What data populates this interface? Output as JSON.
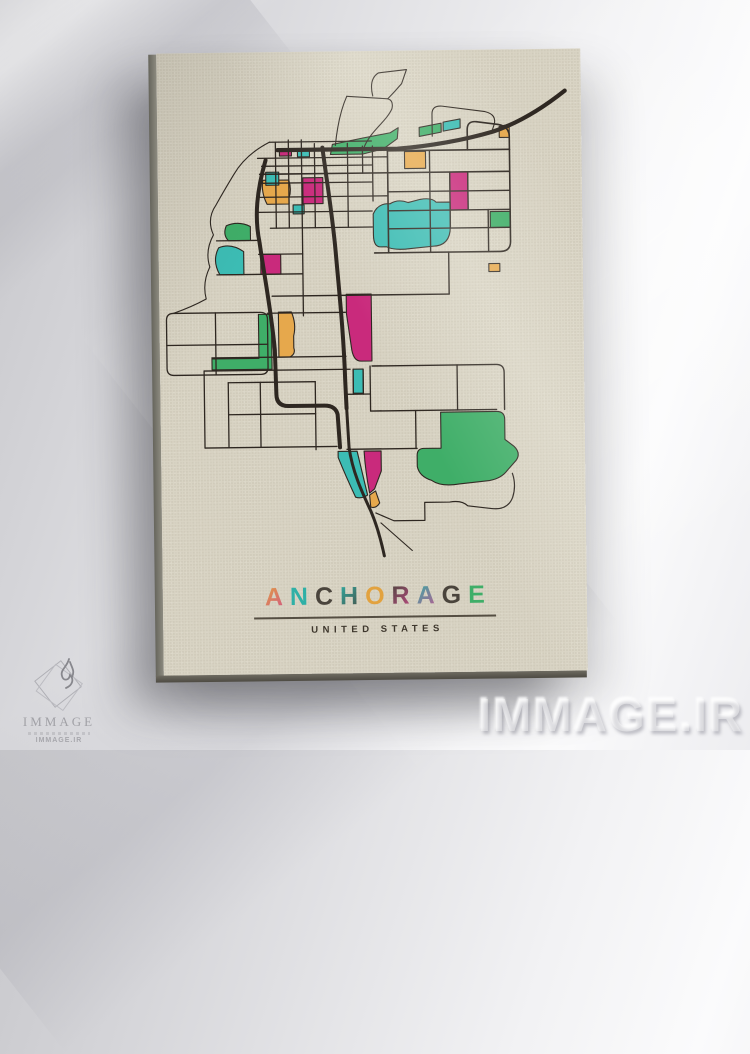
{
  "artwork": {
    "subtitle": "UNITED STATES",
    "title_letters": [
      {
        "ch": "A",
        "c1": "#e2a23f",
        "c2": "#cf4d8e"
      },
      {
        "ch": "N",
        "c1": "#2fb0a6",
        "c2": "#2fb0a6"
      },
      {
        "ch": "C",
        "c1": "#4a443c",
        "c2": "#4a443c"
      },
      {
        "ch": "H",
        "c1": "#2fb0a6",
        "c2": "#4a443c"
      },
      {
        "ch": "O",
        "c1": "#e2a23f",
        "c2": "#e2a23f"
      },
      {
        "ch": "R",
        "c1": "#4a443c",
        "c2": "#cf4d8e"
      },
      {
        "ch": "A",
        "c1": "#2fb0a6",
        "c2": "#cf4d8e"
      },
      {
        "ch": "G",
        "c1": "#4a443c",
        "c2": "#4a443c"
      },
      {
        "ch": "E",
        "c1": "#3fae68",
        "c2": "#3fae68"
      }
    ]
  },
  "watermark": {
    "text": "IMMAGE.IR"
  },
  "logo": {
    "name": "IMMAGE",
    "site": "IMMAGE.IR"
  },
  "map": {
    "colors": {
      "road": "#2e2721",
      "green": "#3fae68",
      "teal": "#3cbcb4",
      "magenta": "#c92a7c",
      "orange": "#e6a84c"
    },
    "parcels": [
      {
        "fill": "green",
        "d": "M173,103 L175,93 L205,87 L233,82 L241,77 L240,88 L226,98 L205,103 Z"
      },
      {
        "fill": "green",
        "d": "M262,77 L284,73 L284,82 L262,86 Z"
      },
      {
        "fill": "teal",
        "d": "M286,72 L303,69 L303,78 L286,81 Z"
      },
      {
        "fill": "orange",
        "d": "M342,77 L352,75 L352,88 L342,88 Z"
      },
      {
        "fill": "orange",
        "d": "M247,101 L268,101 L268,118 L247,118 Z"
      },
      {
        "fill": "magenta",
        "d": "M292,122 L310,122 L310,160 L292,160 Z"
      },
      {
        "fill": "green",
        "d": "M332,162 L352,162 L352,178 L332,178 Z"
      },
      {
        "fill": "teal",
        "d": "M215,163 Q220,152 232,153 Q240,148 250,152 L262,149 Q274,147 278,152 L292,152 L292,176 Q292,196 274,196 L252,198 Q236,200 228,196 L222,196 Q215,196 215,184 Z"
      },
      {
        "fill": "magenta",
        "d": "M145,126 L165,126 L165,152 L145,152 Z"
      },
      {
        "fill": "orange",
        "d": "M105,128 L131,128 Q134,138 131,146 L131,152 L109,152 Q103,140 105,128 Z"
      },
      {
        "fill": "teal",
        "d": "M108,120 L121,120 L121,133 L108,133 Z"
      },
      {
        "fill": "magenta",
        "d": "M122,97 L134,97 L134,104 L122,104 Z"
      },
      {
        "fill": "teal",
        "d": "M140,98 L152,98 L152,105 L140,105 Z"
      },
      {
        "fill": "teal",
        "d": "M135,153 L146,153 L146,162 L135,162 Z"
      },
      {
        "fill": "orange",
        "d": "M330,214 L341,214 L341,222 L330,222 Z"
      },
      {
        "fill": "green",
        "d": "M68,173 Q64,182 70,188 L92,188 L92,174 Q80,168 68,173 Z"
      },
      {
        "fill": "teal",
        "d": "M60,195 Q53,208 61,222 L85,222 L85,199 Q72,190 60,195 Z"
      },
      {
        "fill": "magenta",
        "d": "M102,202 L122,202 L122,222 L102,222 Z"
      },
      {
        "fill": "magenta",
        "d": "M187,243 L212,243 L212,310 L201,310 Q194,310 192,299 L187,262 Z"
      },
      {
        "fill": "teal",
        "d": "M193,318 L203,318 L203,342 L193,342 Z"
      },
      {
        "fill": "orange",
        "d": "M119,260 L132,260 Q137,272 134,284 L134,296 Q136,302 130,305 L119,305 Z"
      },
      {
        "fill": "green",
        "d": "M99,262 L112,262 L112,317 L52,317 L52,306 L99,306 Z"
      },
      {
        "fill": "green",
        "d": "M280,362 L336,362 Q344,362 344,370 L344,390 L353,397 Q360,404 355,411 L346,421 Q340,429 328,431 L298,434 Q280,437 270,430 Q258,426 256,416 L256,405 Q256,398 263,398 L280,398 Z"
      },
      {
        "fill": "teal",
        "d": "M177,400 L196,400 L206,444 Q200,448 194,446 Q184,424 177,406 Z"
      },
      {
        "fill": "magenta",
        "d": "M203,400 L220,400 L220,420 L213,438 L208,442 Q204,420 203,400 Z"
      },
      {
        "fill": "orange",
        "d": "M208,444 L214,440 L218,452 Q214,458 209,456 Z"
      }
    ],
    "roads": [
      {
        "w": 4.2,
        "d": "M408,42 C390,56 364,73 336,82 C308,90 272,96 240,98 L120,98"
      },
      {
        "w": 4.0,
        "d": "M165,96 C169,130 174,162 177,200 C180,240 184,282 185,330 L186,357"
      },
      {
        "w": 4.0,
        "d": "M108,108 C99,138 96,164 101,190 C106,228 112,260 115,298 L116,342 Q116,354 128,354 L164,354 Q175,354 177,363 L179,396"
      },
      {
        "w": 3.0,
        "d": "M186,355 L188,396 C191,420 200,440 209,460 C214,472 219,490 222,505"
      },
      {
        "w": 1.6,
        "d": "M230,97 L230,202"
      },
      {
        "w": 1.6,
        "d": "M352,100 L352,192 Q352,202 342,202 L216,202"
      },
      {
        "w": 1.6,
        "d": "M310,100 L310,80 Q310,71 319,72 L341,75 Q352,77 352,87 L352,100"
      },
      {
        "w": 1.6,
        "d": "M230,100 L352,100"
      },
      {
        "w": 1.6,
        "d": "M102,122 L352,122"
      },
      {
        "w": 1.4,
        "d": "M230,141 L352,141"
      },
      {
        "w": 1.4,
        "d": "M230,160 L352,160"
      },
      {
        "w": 1.4,
        "d": "M230,178 L352,178"
      },
      {
        "w": 1.4,
        "d": "M272,100 L272,202"
      },
      {
        "w": 1.4,
        "d": "M292,122 L292,178"
      },
      {
        "w": 1.4,
        "d": "M310,122 L310,160"
      },
      {
        "w": 1.4,
        "d": "M330,160 L330,202"
      },
      {
        "w": 1.3,
        "d": "M205,95 L205,122"
      },
      {
        "w": 1.3,
        "d": "M215,95 L215,150"
      },
      {
        "w": 1.3,
        "d": "M112,90 L214,90"
      },
      {
        "w": 1.3,
        "d": "M100,106 L230,106"
      },
      {
        "w": 1.3,
        "d": "M104,114 L214,114"
      },
      {
        "w": 1.3,
        "d": "M104,131 L214,131"
      },
      {
        "w": 1.3,
        "d": "M100,145 L230,145"
      },
      {
        "w": 1.3,
        "d": "M100,160 L214,160"
      },
      {
        "w": 1.3,
        "d": "M112,176 L214,176"
      },
      {
        "w": 1.3,
        "d": "M118,90 L118,176"
      },
      {
        "w": 1.3,
        "d": "M131,88 L131,176"
      },
      {
        "w": 1.3,
        "d": "M144,88 L144,264"
      },
      {
        "w": 1.3,
        "d": "M157,92 L157,176"
      },
      {
        "w": 1.3,
        "d": "M190,92 L190,176"
      },
      {
        "w": 1.1,
        "d": "M112,90 Q88,102 76,122 Q66,138 58,152 Q48,166 55,182 Q46,198 51,214 Q43,230 47,246 Q32,254 14,260"
      },
      {
        "w": 1.3,
        "d": "M58,188 L100,188"
      },
      {
        "w": 1.3,
        "d": "M58,222 L144,222"
      },
      {
        "w": 1.3,
        "d": "M100,202 L144,202"
      },
      {
        "w": 1.4,
        "d": "M113,244 L290,244"
      },
      {
        "w": 1.4,
        "d": "M290,244 L290,202"
      },
      {
        "w": 1.3,
        "d": "M14,260 Q7,260 7,267 L7,315 Q7,322 14,322 L101,322 Q108,322 108,315 L108,267 Q108,260 101,260 Z"
      },
      {
        "w": 1.3,
        "d": "M56,260 L56,322"
      },
      {
        "w": 1.3,
        "d": "M7,292 L108,292"
      },
      {
        "w": 1.3,
        "d": "M108,261 L186,261"
      },
      {
        "w": 1.3,
        "d": "M52,305 L186,305"
      },
      {
        "w": 1.3,
        "d": "M44,318 L190,318"
      },
      {
        "w": 1.3,
        "d": "M44,318 L44,395"
      },
      {
        "w": 1.3,
        "d": "M68,330 L155,330"
      },
      {
        "w": 1.3,
        "d": "M68,330 L68,395"
      },
      {
        "w": 1.3,
        "d": "M100,330 L100,395"
      },
      {
        "w": 1.3,
        "d": "M155,330 L155,398"
      },
      {
        "w": 1.3,
        "d": "M44,395 L176,395"
      },
      {
        "w": 1.3,
        "d": "M68,362 L155,362"
      },
      {
        "w": 1.3,
        "d": "M193,318 L193,343"
      },
      {
        "w": 1.3,
        "d": "M203,318 L203,343"
      },
      {
        "w": 1.3,
        "d": "M186,343 L210,343"
      },
      {
        "w": 1.3,
        "d": "M210,315 L210,360"
      },
      {
        "w": 1.4,
        "d": "M212,315 L336,315 Q344,315 344,323 L344,360"
      },
      {
        "w": 1.4,
        "d": "M210,360 L336,360"
      },
      {
        "w": 1.3,
        "d": "M255,360 L255,398"
      },
      {
        "w": 1.3,
        "d": "M297,315 L297,360"
      },
      {
        "w": 1.4,
        "d": "M186,398 L256,398"
      },
      {
        "w": 1.2,
        "d": "M214,462 L232,470 L263,470 L263,452 L288,452 Q300,450 306,456 L330,459 Q346,461 351,448 Q355,436 351,424"
      },
      {
        "w": 1.1,
        "d": "M219,472 L250,500"
      },
      {
        "w": 1.1,
        "d": "M190,45 L231,48 Q237,50 235,58 C231,67 222,74 214,84 Q208,92 206,98"
      },
      {
        "w": 1.1,
        "d": "M178,94 C180,76 184,58 190,45"
      },
      {
        "w": 1.1,
        "d": "M216,45 Q212,28 222,22 L250,19 L245,33 Q238,41 231,48"
      },
      {
        "w": 1.1,
        "d": "M275,86 L275,64 Q275,55 285,56 L328,62 Q340,65 337,75 L334,84"
      }
    ]
  }
}
